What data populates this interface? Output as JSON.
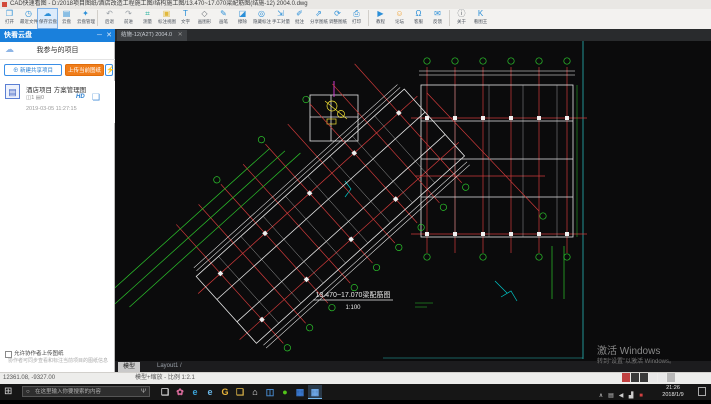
{
  "window": {
    "title": "CAD快速看图 - D:/2018项目图纸/酒店改造工程施工图/结构施工图/13.470~17.070梁配筋图(结施-12) 2004.0.dwg"
  },
  "toolbar": {
    "active_index": 2,
    "separators_after": [
      4,
      18,
      22
    ],
    "items": [
      {
        "name": "open",
        "label": "打开",
        "glyph": "❐",
        "color": "#2b8fd8"
      },
      {
        "name": "recent-files",
        "label": "最近文件",
        "glyph": "◷",
        "color": "#2b8fd8"
      },
      {
        "name": "save-cloud",
        "label": "保存云盘",
        "glyph": "☁",
        "color": "#2b8fd8"
      },
      {
        "name": "cloud-drive",
        "label": "云盘",
        "glyph": "▤",
        "color": "#2b8fd8"
      },
      {
        "name": "cloud-manage",
        "label": "云盘管理",
        "glyph": "✦",
        "color": "#2b8fd8"
      },
      {
        "name": "undo",
        "label": "后退",
        "glyph": "↶",
        "color": "#9aa0a6"
      },
      {
        "name": "redo",
        "label": "前进",
        "glyph": "↷",
        "color": "#9aa0a6"
      },
      {
        "name": "measure",
        "label": "测量",
        "glyph": "⌗",
        "color": "#2bb3a0"
      },
      {
        "name": "annotate-view",
        "label": "标注视图",
        "glyph": "▣",
        "color": "#e2b93b"
      },
      {
        "name": "text",
        "label": "文字",
        "glyph": "T",
        "color": "#2b8fd8"
      },
      {
        "name": "draw-shape",
        "label": "画图形",
        "glyph": "◇",
        "color": "#6a6f75"
      },
      {
        "name": "pen",
        "label": "画笔",
        "glyph": "✎",
        "color": "#2b8fd8"
      },
      {
        "name": "erase",
        "label": "擦除",
        "glyph": "◪",
        "color": "#2b8fd8"
      },
      {
        "name": "hide-annotation",
        "label": "隐藏标注",
        "glyph": "◎",
        "color": "#2b8fd8"
      },
      {
        "name": "manual-takeoff",
        "label": "手工对量",
        "glyph": "⇲",
        "color": "#2b8fd8"
      },
      {
        "name": "comment",
        "label": "批注",
        "glyph": "✐",
        "color": "#2b8fd8"
      },
      {
        "name": "share-drawing",
        "label": "分享图纸",
        "glyph": "⇗",
        "color": "#2b8fd8"
      },
      {
        "name": "adjust-drawing",
        "label": "调整图纸",
        "glyph": "⟳",
        "color": "#2b8fd8"
      },
      {
        "name": "print",
        "label": "打印",
        "glyph": "⎙",
        "color": "#2b8fd8"
      },
      {
        "name": "tutorial",
        "label": "教程",
        "glyph": "▶",
        "color": "#2b8fd8"
      },
      {
        "name": "forum",
        "label": "论坛",
        "glyph": "☺",
        "color": "#f0a030"
      },
      {
        "name": "support",
        "label": "客服",
        "glyph": "Ω",
        "color": "#2b8fd8"
      },
      {
        "name": "feedback",
        "label": "反馈",
        "glyph": "✉",
        "color": "#2b8fd8"
      },
      {
        "name": "about",
        "label": "关于",
        "glyph": "ⓘ",
        "color": "#6a6f75"
      },
      {
        "name": "kantuwang",
        "label": "看图王",
        "glyph": "K",
        "color": "#2b8fd8"
      }
    ]
  },
  "panel": {
    "title": "快看云盘",
    "minimize_glyph": "─",
    "close_glyph": "✕",
    "cloud_icon": "☁",
    "section_title": "我参与的项目",
    "btn_new": "⊕ 新建共享项目",
    "btn_upload": "上传当前图纸",
    "btn_bolt": "⚡",
    "project": {
      "icon_glyph": "▤",
      "name": "酒店项目 方案管理图",
      "stats": "◫1  ▤0",
      "badge": "HD",
      "folder_glyph": "❏",
      "date": "2019-03-05 11:27:15"
    },
    "checkbox_label": "允许协作者上传图纸",
    "hint": "协作者可同步查看和标注当前项目的图纸信息"
  },
  "drawing": {
    "tab_label": "结施-12(A2T) 2004.0",
    "tab_close": "✕",
    "model_tab": "模型",
    "layout_tabs": "Layout1 /",
    "plan_title": "13.470~17.070梁配筋图",
    "plan_scale": "1:100",
    "watermark_line1": "激活 Windows",
    "watermark_line2": "转到“设置”以激活 Windows。"
  },
  "statusbar": {
    "coords": "12361.08, -9327.00",
    "hint": "模型+缩放 - 比例 1:2.1"
  },
  "taskbar": {
    "start_glyph": "⊞",
    "search_icon": "○",
    "search_placeholder": "在这里输入你要搜索的内容",
    "mic_glyph": "Ψ",
    "icons": [
      {
        "name": "task-view",
        "glyph": "❏",
        "color": "#e0e0e0"
      },
      {
        "name": "app-pink",
        "glyph": "✿",
        "color": "#d86a9a"
      },
      {
        "name": "edge",
        "glyph": "e",
        "color": "#3aa3d8"
      },
      {
        "name": "ie",
        "glyph": "e",
        "color": "#6ab8e8"
      },
      {
        "name": "app-g",
        "glyph": "G",
        "color": "#e8b43a"
      },
      {
        "name": "explorer",
        "glyph": "❑",
        "color": "#e0b84a"
      },
      {
        "name": "store",
        "glyph": "⌂",
        "color": "#e8e8e8"
      },
      {
        "name": "photos",
        "glyph": "◫",
        "color": "#4a90d8"
      },
      {
        "name": "wechat",
        "glyph": "●",
        "color": "#52c41a"
      },
      {
        "name": "cad-app",
        "glyph": "▦",
        "color": "#3a7bd5"
      },
      {
        "name": "cad-viewer-active",
        "glyph": "▦",
        "color": "#6ea8e8",
        "active": true
      }
    ],
    "tray": [
      {
        "name": "tray-expand",
        "glyph": "∧",
        "color": "#cccccc"
      },
      {
        "name": "tray-battery",
        "glyph": "▤",
        "color": "#cccccc"
      },
      {
        "name": "tray-volume",
        "glyph": "◀",
        "color": "#cccccc"
      },
      {
        "name": "tray-network",
        "glyph": "▟",
        "color": "#cccccc"
      },
      {
        "name": "tray-security",
        "glyph": "■",
        "color": "#d04040"
      }
    ],
    "ime_boxes": [
      "#c04040",
      "#3a3a3a",
      "#3a3a3a",
      "#e8e8e8",
      "#e8e8e8",
      "#b8b8b8"
    ],
    "time": "21:26",
    "date": "2018/1/9"
  }
}
